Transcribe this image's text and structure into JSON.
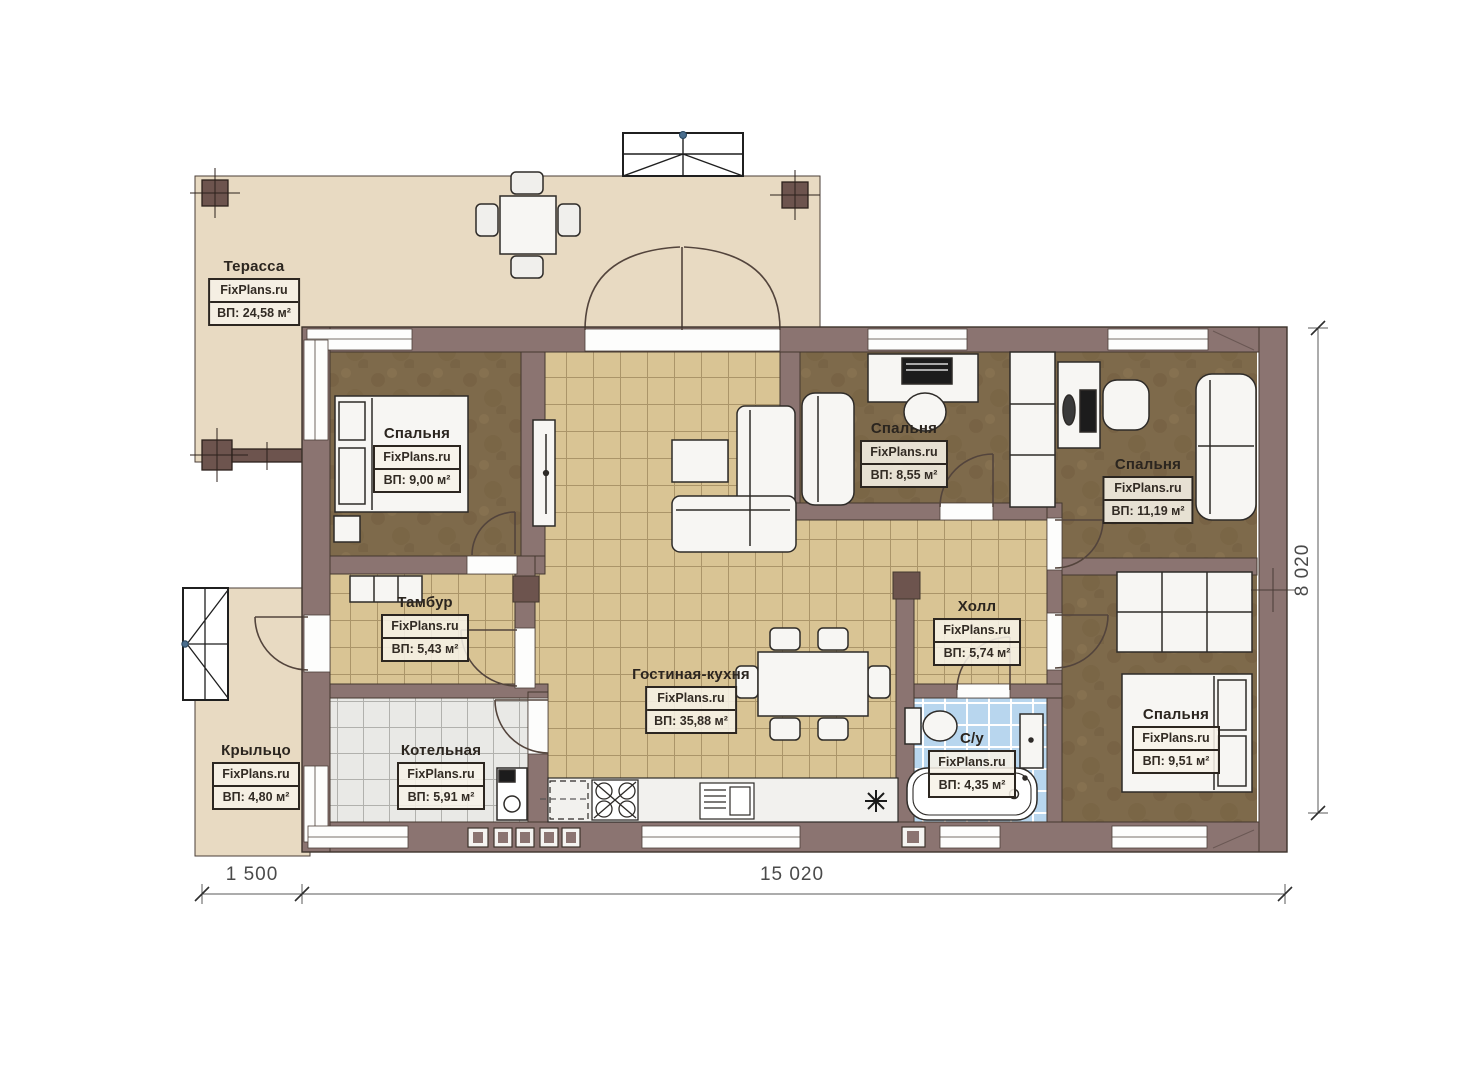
{
  "watermark": "FixPlans.ru",
  "rooms": {
    "terrace": {
      "name": "Терасса",
      "area": "ВП: 24,58 м²"
    },
    "bedroom_left": {
      "name": "Спальня",
      "area": "ВП: 9,00 м²"
    },
    "bedroom_middle": {
      "name": "Спальня",
      "area": "ВП: 8,55 м²"
    },
    "bedroom_right": {
      "name": "Спальня",
      "area": "ВП: 11,19 м²"
    },
    "bedroom_bottom": {
      "name": "Спальня",
      "area": "ВП: 9,51 м²"
    },
    "tambour": {
      "name": "Тамбур",
      "area": "ВП: 5,43 м²"
    },
    "hall": {
      "name": "Холл",
      "area": "ВП: 5,74 м²"
    },
    "living_kitchen": {
      "name": "Гостиная-кухня",
      "area": "ВП: 35,88 м²"
    },
    "boiler": {
      "name": "Котельная",
      "area": "ВП: 5,91 м²"
    },
    "bathroom": {
      "name": "С/у",
      "area": "ВП: 4,35 м²"
    },
    "porch": {
      "name": "Крыльцо",
      "area": "ВП: 4,80 м²"
    }
  },
  "dimensions": {
    "left_segment": "1 500",
    "bottom_segment": "15 020",
    "right_segment": "8 020"
  },
  "colors": {
    "wall": "#8b7471",
    "terrace_floor": "#e8dac2",
    "tile_floor": "#d9c494",
    "bedroom_floor": "#7e6a4b",
    "bathroom_tile": "#b8d6ee",
    "boiler_tile": "#e9e9e6"
  }
}
